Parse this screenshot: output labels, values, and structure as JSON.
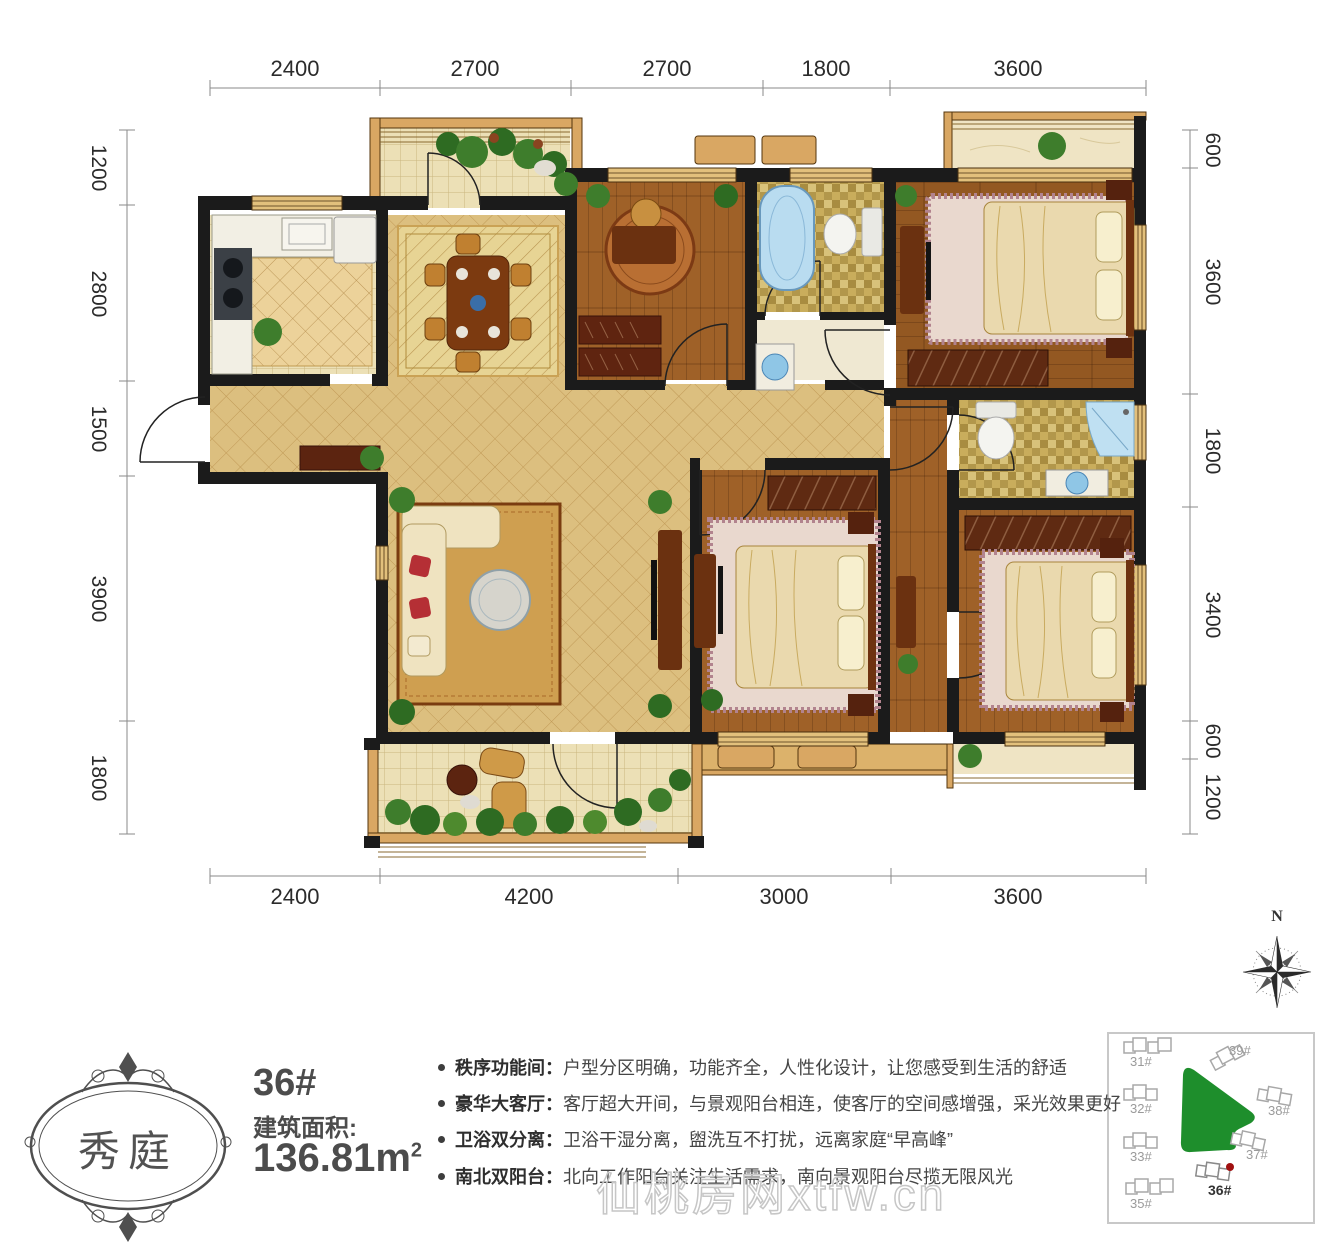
{
  "plan": {
    "dims_top": [
      "2400",
      "2700",
      "2700",
      "1800",
      "3600"
    ],
    "dims_bottom": [
      "2400",
      "4200",
      "3000",
      "3600"
    ],
    "dims_left": [
      "1200",
      "2800",
      "1500",
      "3900",
      "1800"
    ],
    "dims_right": [
      "600",
      "3600",
      "1800",
      "3400",
      "600",
      "1200"
    ]
  },
  "info": {
    "unit": "36#",
    "area_label": "建筑面积:",
    "area_value": "136.81m",
    "area_sup": "2",
    "features": [
      {
        "label": "秩序功能间：",
        "text": "户型分区明确，功能齐全，人性化设计，让您感受到生活的舒适"
      },
      {
        "label": "豪华大客厅：",
        "text": "客厅超大开间，与景观阳台相连，使客厅的空间感增强，采光效果更好"
      },
      {
        "label": "卫浴双分离：",
        "text": "卫浴干湿分离，盥洗互不打扰，远离家庭“早高峰”"
      },
      {
        "label": "南北双阳台：",
        "text": "北向工作阳台关注生活需求，南向景观阳台尽揽无限风光"
      }
    ]
  },
  "logo": {
    "text": "秀庭"
  },
  "compass": {
    "north_label": "N"
  },
  "watermark": {
    "text": "仙桃房网xtfw.cn"
  },
  "sitemap": {
    "highlight": "36#",
    "green_color": "#1e8e2c",
    "marker_color": "#a01010",
    "buildings": [
      {
        "label": "31#"
      },
      {
        "label": "32#"
      },
      {
        "label": "33#"
      },
      {
        "label": "35#"
      },
      {
        "label": "36#"
      },
      {
        "label": "37#"
      },
      {
        "label": "38#"
      },
      {
        "label": "39#"
      }
    ]
  },
  "colors": {
    "tile": "#dcbf7f",
    "wood": "#9a5c24",
    "wall": "#1b1b1b"
  }
}
